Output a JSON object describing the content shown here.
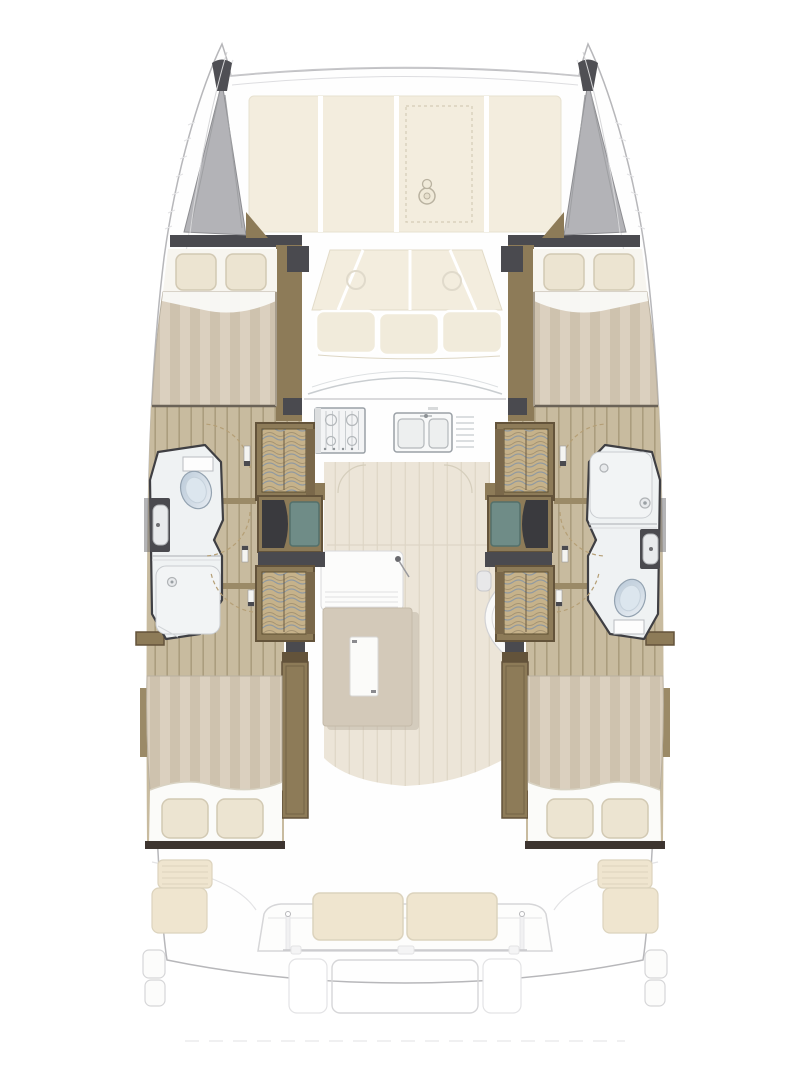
{
  "meta": {
    "type": "floor-plan",
    "subject": "catamaran-interior-top-view",
    "width_px": 810,
    "height_px": 1080
  },
  "icons": [
    "windlass-icon",
    "toilet-icon",
    "bathroom-sink-icon",
    "shower-drain-icon",
    "shower-head-icon",
    "stove-icon",
    "double-sink-icon",
    "door-swing-arc",
    "door-leaf-icon"
  ],
  "regions": [
    "port-bow",
    "starboard-bow",
    "foredeck-sunpads",
    "forward-cockpit-sofa",
    "saloon",
    "galley",
    "nav-counter",
    "saloon-table",
    "stair-curve",
    "port-forward-cabin",
    "starboard-forward-cabin",
    "port-head",
    "starboard-head",
    "port-wardrobes",
    "starboard-wardrobes",
    "port-aft-cabin",
    "starboard-aft-cabin",
    "aft-cockpit",
    "aft-bench",
    "swim-platform"
  ],
  "colors": {
    "background": "#ffffff",
    "hull_fill": "#fefefe",
    "outline_faint": "#d6d6d8",
    "outline_mid": "#b7b7ba",
    "ghost": "#e3e3e5",
    "dark_gray": "#4a4a4f",
    "darker_gray": "#3a3a3e",
    "bow_gray": "#b3b3b7",
    "bow_gray_edge": "#8d8d91",
    "bow_tip_dark": "#4f4f54",
    "cream_deck": "#f3edde",
    "cream_stroke": "#e2dbc8",
    "cream_cushion": "#f1ebdb",
    "wood_wall": "#8d7b58",
    "wood_wall_dark": "#63533a",
    "wood_wall_deep": "#7a684a",
    "wood_light": "#9b8a67",
    "plank": "#c8bb9f",
    "plank_line": "#ab9d7e",
    "saloon_floor": "#ece5d8",
    "saloon_grain": "#e0d8c8",
    "duvet_a": "#dbd0bf",
    "duvet_b": "#cec2ae",
    "sheet_white": "#fbfbf9",
    "pillow": "#ece4d1",
    "pillow_stroke": "#d2c9b3",
    "hatch_base": "#c6b28a",
    "hatch_wave": "#8795a3",
    "hatch_wave2": "#9c8c6d",
    "teal": "#6f8c87",
    "teal_dark": "#53706b",
    "bath_fill": "#eff2f3",
    "bath_stroke": "#3f3f43",
    "toilet_a": "#b9c9d8",
    "toilet_b": "#e9eef3",
    "steel": "#9aa0a6",
    "light_line": "#c9cdd0",
    "table_tan": "#d3c9b9",
    "table_shadow": "#b9ae9d",
    "white_panel": "#fbfbf9",
    "cockpit_cream": "#efe5cf",
    "cockpit_line": "#dcd3bd",
    "dark_bulkhead": "#3d3530",
    "arc_dash": "#b59f76"
  }
}
